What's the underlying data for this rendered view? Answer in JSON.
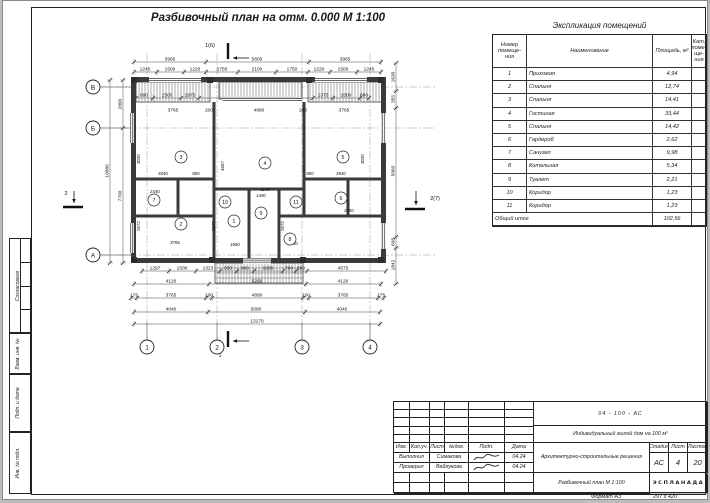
{
  "sheet": {
    "plan_title": "Разбивочный план на отм. 0.000 М 1:100",
    "format_label": "Формат А3",
    "format_size": "297 x 420"
  },
  "explication": {
    "title": "Экспликация помещений",
    "col_num": "Номер\nпомеще-\nния",
    "col_name": "Наименование",
    "col_area": "Площадь, м²",
    "col_cat": "Кат.\nпоме-\nще-\nния",
    "rows": [
      {
        "num": "1",
        "name": "Прихожая",
        "area": "4,94"
      },
      {
        "num": "2",
        "name": "Спальня",
        "area": "12,74"
      },
      {
        "num": "3",
        "name": "Спальня",
        "area": "14,41"
      },
      {
        "num": "4",
        "name": "Гостиная",
        "area": "33,44"
      },
      {
        "num": "5",
        "name": "Спальня",
        "area": "14,42"
      },
      {
        "num": "6",
        "name": "Гардероб",
        "area": "2,62"
      },
      {
        "num": "7",
        "name": "Санузел",
        "area": "9,98"
      },
      {
        "num": "8",
        "name": "Котельная",
        "area": "5,34"
      },
      {
        "num": "9",
        "name": "Туалет",
        "area": "2,21"
      },
      {
        "num": "10",
        "name": "Коридор",
        "area": "1,23"
      },
      {
        "num": "11",
        "name": "Коридор",
        "area": "1,23"
      }
    ],
    "total_label": "Общий итог",
    "total_area": "102,56"
  },
  "title_block": {
    "doc_number": "04 - 100 - АС",
    "project_name": "Индивидуальный жилой дом на 100 м²",
    "section_name": "Архитектурно-строительные решения",
    "drawing_name": "Разбивочный план М 1:100",
    "company": "ЭСПЛАНАДА",
    "stage_label": "Стадия",
    "sheet_label": "Лист",
    "sheets_label": "Листов",
    "stage": "АС",
    "sheet": "4",
    "sheets": "20",
    "header_cols": [
      "Изм.",
      "Кол.уч.",
      "Лист",
      "№док.",
      "Подп.",
      "Дата"
    ],
    "roles": [
      {
        "role": "Выполнил",
        "name": "Симакова",
        "date": "04.24"
      },
      {
        "role": "Проверил",
        "name": "Ваблукова",
        "date": "04.24"
      }
    ]
  },
  "side_strip": {
    "agreed": "Согласовано",
    "fields": [
      "Взам. инв. №",
      "Подп. и дата",
      "Инв. № подл."
    ]
  },
  "plan": {
    "axes_bottom": [
      [
        "1",
        144
      ],
      [
        "2",
        214
      ],
      [
        "3",
        299
      ],
      [
        "4",
        367
      ]
    ],
    "axes_left": [
      [
        "В",
        86
      ],
      [
        "Б",
        127
      ],
      [
        "А",
        254
      ]
    ],
    "sections": [
      {
        "t": "1(6)",
        "x": 207,
        "y": 46
      },
      {
        "t": "1",
        "x": 217,
        "y": 356
      },
      {
        "t": "2",
        "x": 63,
        "y": 194
      },
      {
        "t": "2(7)",
        "x": 432,
        "y": 199
      }
    ],
    "rooms": [
      {
        "n": "1",
        "x": 231,
        "y": 220
      },
      {
        "n": "2",
        "x": 178,
        "y": 223
      },
      {
        "n": "3",
        "x": 178,
        "y": 156
      },
      {
        "n": "4",
        "x": 262,
        "y": 162
      },
      {
        "n": "5",
        "x": 340,
        "y": 156
      },
      {
        "n": "6",
        "x": 338,
        "y": 197
      },
      {
        "n": "7",
        "x": 151,
        "y": 199
      },
      {
        "n": "8",
        "x": 287,
        "y": 238
      },
      {
        "n": "9",
        "x": 258,
        "y": 212
      },
      {
        "n": "10",
        "x": 222,
        "y": 201
      },
      {
        "n": "11",
        "x": 293,
        "y": 201
      }
    ],
    "dim_rows_h": [
      {
        "y": 61,
        "ticks": [
          131,
          203,
          306,
          378
        ],
        "labels": [
          [
            "3965",
            167
          ],
          [
            "5600",
            254
          ],
          [
            "3965",
            342
          ]
        ]
      },
      {
        "y": 71,
        "ticks": [
          131,
          154,
          181,
          203,
          235,
          273,
          305,
          327,
          354,
          378
        ],
        "labels": [
          [
            "1245",
            142
          ],
          [
            "1500",
            167
          ],
          [
            "1220",
            192
          ],
          [
            "1750",
            219
          ],
          [
            "2100",
            254
          ],
          [
            "1750",
            289
          ],
          [
            "1220",
            316
          ],
          [
            "1500",
            340
          ],
          [
            "1245",
            366
          ]
        ]
      },
      {
        "y": 97,
        "ticks": [
          133,
          150,
          178,
          196,
          310,
          330,
          357,
          366
        ],
        "labels": [
          [
            "890",
            141
          ],
          [
            "1500",
            164
          ],
          [
            "1975",
            187
          ],
          [
            "1375",
            320
          ],
          [
            "1500",
            343
          ],
          [
            "890",
            361
          ]
        ]
      },
      {
        "y": 112,
        "ticks": [],
        "labels": [
          [
            "3765",
            170
          ],
          [
            "200",
            206
          ],
          [
            "4890",
            256
          ],
          [
            "200",
            300
          ],
          [
            "3765",
            341
          ]
        ]
      },
      {
        "y": 270,
        "ticks": [
          139,
          166,
          193,
          217,
          234,
          251,
          280,
          293,
          304,
          383
        ],
        "labels": [
          [
            "1297",
            152
          ],
          [
            "1500",
            179
          ],
          [
            "1323",
            205
          ],
          [
            "950",
            225
          ],
          [
            "900",
            242
          ],
          [
            "1585",
            265
          ],
          [
            "700",
            286
          ],
          [
            "600",
            298
          ],
          [
            "4675",
            340
          ]
        ]
      },
      {
        "y": 283,
        "ticks": [
          131,
          206,
          303,
          378
        ],
        "labels": [
          [
            "4120",
            168
          ],
          [
            "5290",
            254
          ],
          [
            "4120",
            340
          ]
        ]
      },
      {
        "y": 297,
        "ticks": [
          128,
          134,
          203,
          209,
          300,
          306,
          375,
          381
        ],
        "labels": [
          [
            "175",
            131
          ],
          [
            "3765",
            168
          ],
          [
            "100",
            206
          ],
          [
            "4890",
            254
          ],
          [
            "100",
            303
          ],
          [
            "3765",
            340
          ],
          [
            "175",
            378
          ]
        ]
      },
      {
        "y": 311,
        "ticks": [
          131,
          205,
          302,
          377
        ],
        "labels": [
          [
            "4040",
            168
          ],
          [
            "5090",
            253
          ],
          [
            "4040",
            339
          ]
        ]
      },
      {
        "y": 323,
        "ticks": [
          131,
          377
        ],
        "labels": [
          [
            "13170",
            254
          ]
        ]
      }
    ],
    "dim_rows_v": [
      {
        "x": 107,
        "ticks": [
          79,
          262
        ],
        "labels": [
          [
            "10080",
            170
          ]
        ]
      },
      {
        "x": 120,
        "ticks": [
          79,
          127,
          262
        ],
        "labels": [
          [
            "2890",
            103
          ],
          [
            "7700",
            195
          ]
        ]
      },
      {
        "x": 393,
        "ticks": [
          62,
          90,
          107,
          236,
          247,
          283
        ],
        "labels": [
          [
            "1630",
            76
          ],
          [
            "355",
            98
          ],
          [
            "5960",
            170
          ],
          [
            "608",
            241
          ],
          [
            "1842",
            264
          ]
        ]
      }
    ],
    "inner_dims": [
      [
        "3020",
        137,
        158,
        1
      ],
      [
        "4657",
        221,
        165,
        1
      ],
      [
        "3020",
        361,
        158,
        1
      ],
      [
        "2840",
        160,
        174,
        0
      ],
      [
        "800",
        193,
        174,
        0
      ],
      [
        "2840",
        338,
        174,
        0
      ],
      [
        "800",
        307,
        174,
        0
      ],
      [
        "2440",
        152,
        192,
        0
      ],
      [
        "2440",
        346,
        211,
        0
      ],
      [
        "2672",
        137,
        225,
        1
      ],
      [
        "3765",
        172,
        243,
        0
      ],
      [
        "2672",
        212,
        225,
        1
      ],
      [
        "1950",
        232,
        245,
        0
      ],
      [
        "1400",
        258,
        196,
        0
      ],
      [
        "2440",
        290,
        244,
        0
      ],
      [
        "2672",
        281,
        225,
        1
      ],
      [
        "1140",
        262,
        190,
        0
      ]
    ]
  }
}
